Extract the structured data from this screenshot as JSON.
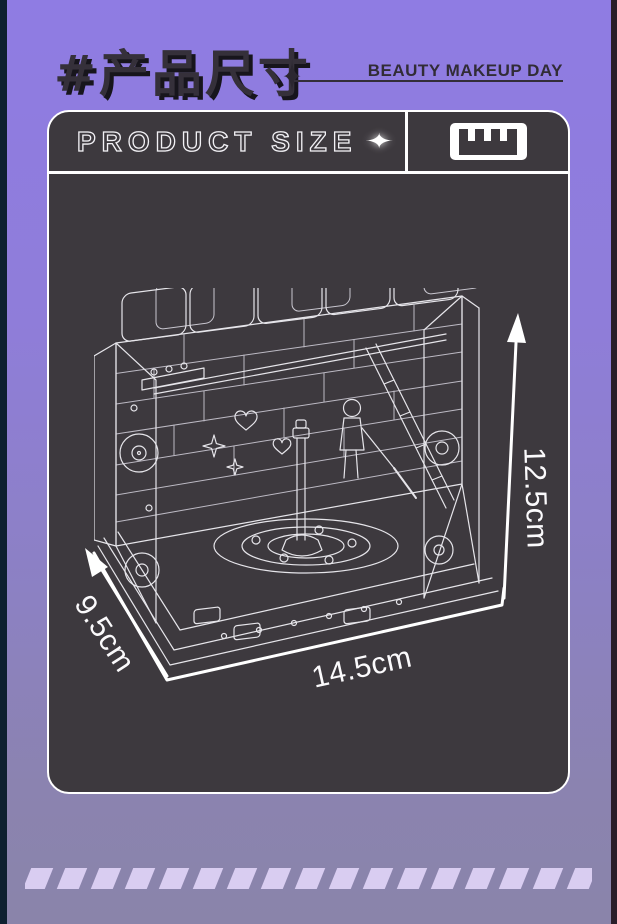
{
  "header": {
    "hashtag_title": "#产品尺寸",
    "sparkle_icon": "✦",
    "brand": "BEAUTY MAKEUP DAY"
  },
  "panel": {
    "title": "PRODUCT SIZE",
    "sparkle_icon": "✦"
  },
  "dimensions": {
    "height_label": "12.5cm",
    "depth_label": "9.5cm",
    "width_label": "14.5cm"
  },
  "icons": {
    "ruler": "ruler-comb",
    "sparkle": "✦"
  },
  "footer": {
    "stripe_count": 18
  },
  "colors": {
    "background_top": "#8f7ce3",
    "background_bottom": "#8a84aa",
    "panel_background": "#3d393e",
    "panel_border": "#ffffff",
    "heading_text": "#35303a",
    "heading_shadow": "#17151c",
    "brand_text": "#312c36",
    "line_art": "#e6e5ea",
    "dimension_text": "#fbfafc",
    "stripe": "#d9cdf1",
    "left_edge": "#0e2030",
    "right_edge": "#291d29"
  }
}
